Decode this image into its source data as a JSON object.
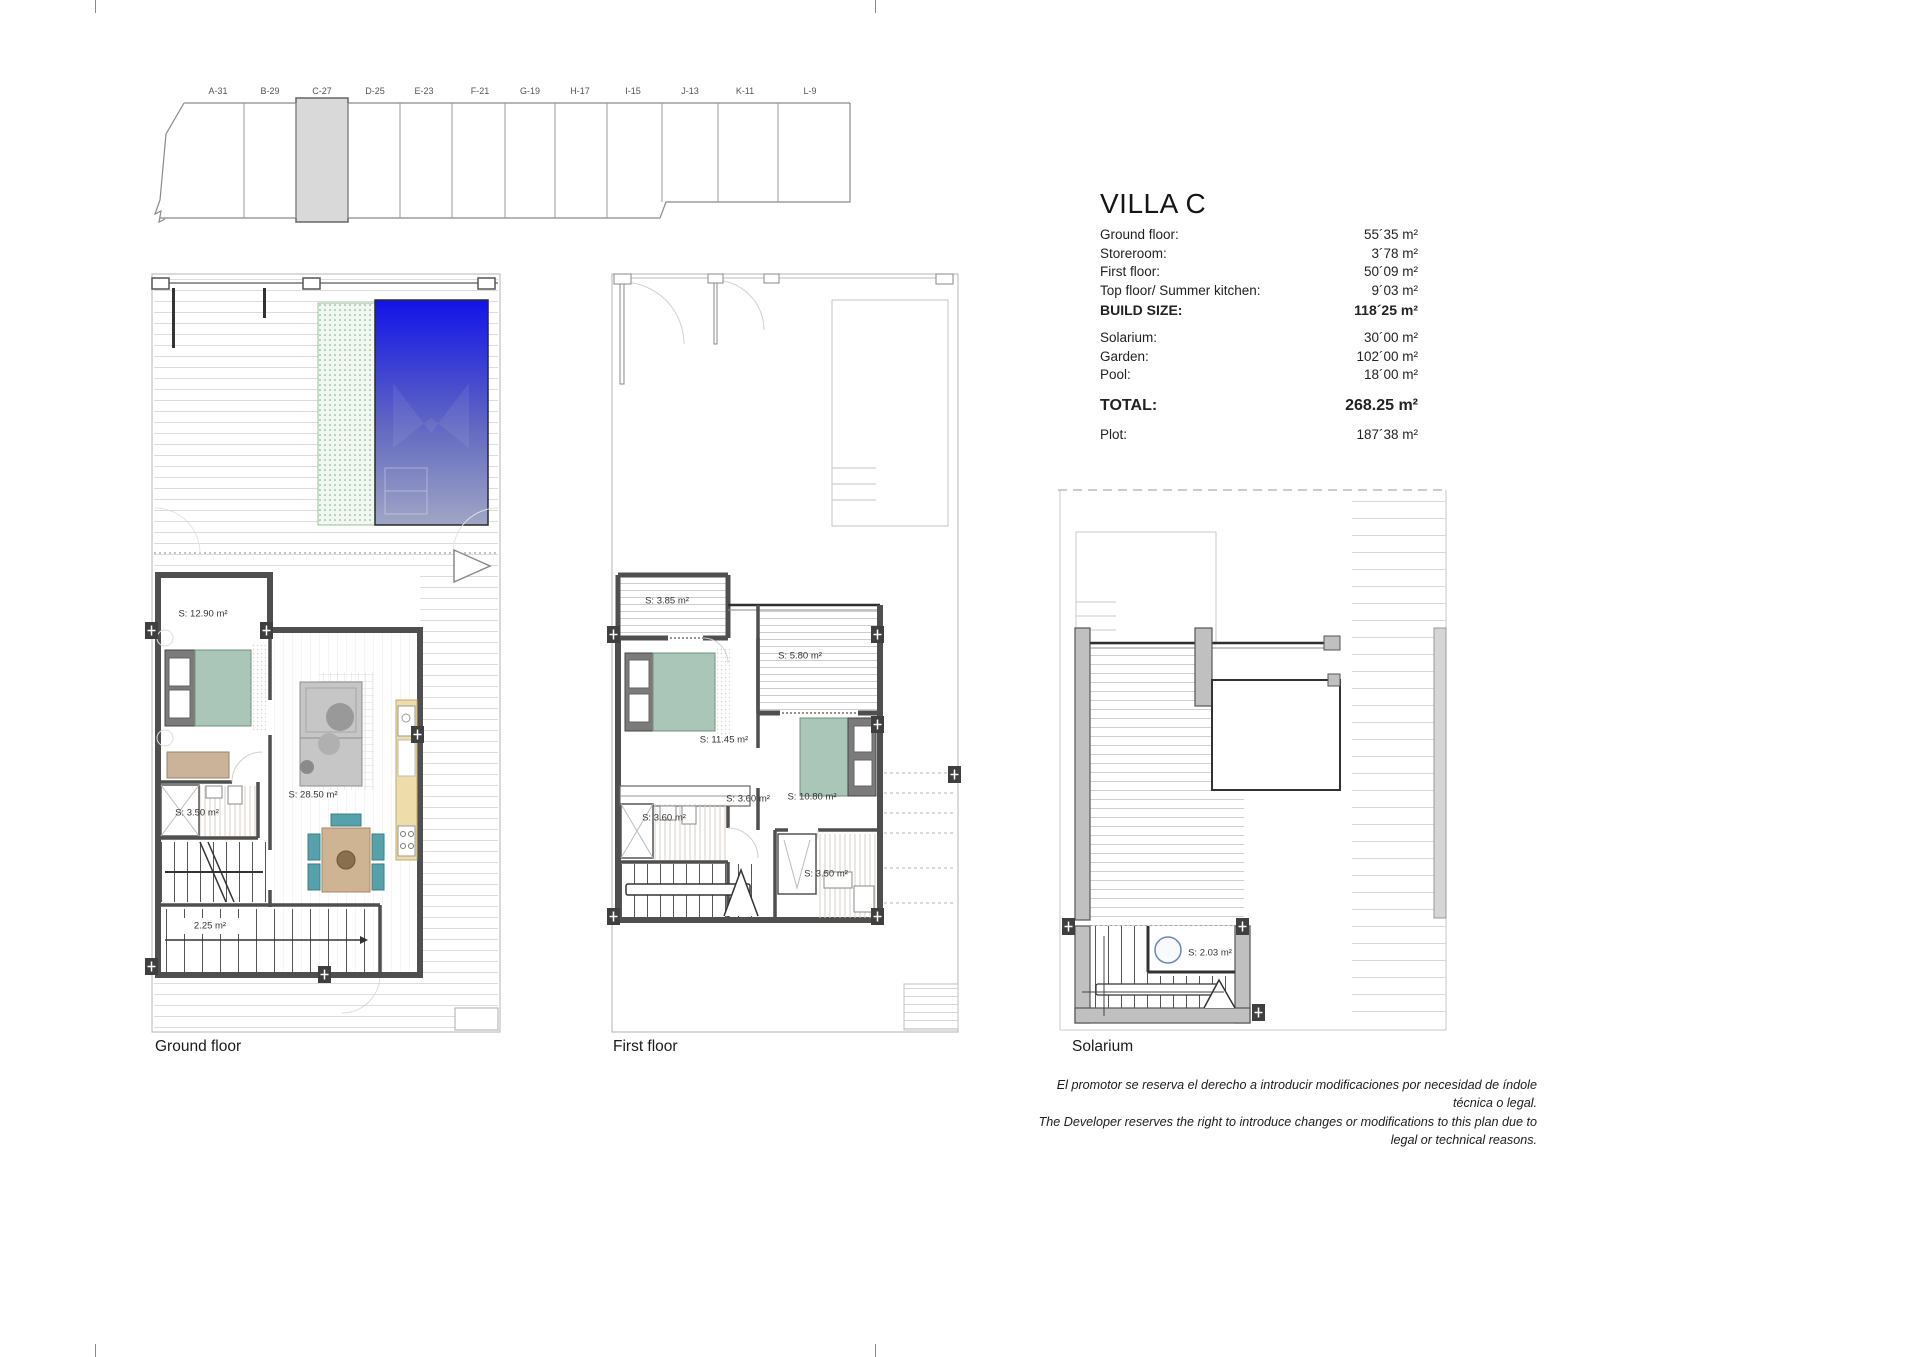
{
  "page": {
    "title": "VILLA C"
  },
  "siteplan": {
    "highlighted_unit": "C-27",
    "units": [
      {
        "label": "A-31"
      },
      {
        "label": "B-29"
      },
      {
        "label": "C-27"
      },
      {
        "label": "D-25"
      },
      {
        "label": "E-23"
      },
      {
        "label": "F-21"
      },
      {
        "label": "G-19"
      },
      {
        "label": "H-17"
      },
      {
        "label": "I-15"
      },
      {
        "label": "J-13"
      },
      {
        "label": "K-11"
      },
      {
        "label": "L-9"
      }
    ]
  },
  "areas": {
    "rows": [
      {
        "label": "Ground floor:",
        "value": "55´35 m²"
      },
      {
        "label": "Storeroom:",
        "value": "3´78 m²"
      },
      {
        "label": "First floor:",
        "value": "50´09 m²"
      },
      {
        "label": "Top floor/ Summer kitchen:",
        "value": "9´03 m²"
      },
      {
        "label": "BUILD SIZE:",
        "value": "118´25 m²"
      },
      {
        "label": "Solarium:",
        "value": "30´00 m²"
      },
      {
        "label": "Garden:",
        "value": "102´00 m²"
      },
      {
        "label": "Pool:",
        "value": "18´00 m²"
      },
      {
        "label": "TOTAL:",
        "value": "268.25 m²"
      },
      {
        "label": "Plot:",
        "value": "187´38 m²"
      }
    ]
  },
  "plans": {
    "ground": {
      "caption": "Ground floor",
      "rooms": {
        "bedroom": "S: 12.90 m²",
        "living": "S: 28.50 m²",
        "bath": "S: 3.50 m²",
        "store": "2.25 m²"
      }
    },
    "first": {
      "caption": "First floor",
      "rooms": {
        "balcony": "S: 3.85 m²",
        "terrace": "S: 5.80 m²",
        "bedroom1": "S: 11.45 m²",
        "hall": "S: 3.60 m²",
        "bath1": "S: 3.60 m²",
        "bedroom2": "S: 10.80 m²",
        "bath2": "S: 3.50 m²"
      }
    },
    "solarium": {
      "caption": "Solarium",
      "rooms": {
        "store": "S: 2.03 m²"
      }
    }
  },
  "disclaimer": {
    "es": "El promotor se reserva el derecho a introducir modificaciones por necesidad de índole técnica o legal.",
    "en": "The Developer reserves the right to introduce changes or modifications to this plan due to legal or technical reasons."
  },
  "colors": {
    "pool_top": "#1113e6",
    "pool_bottom": "#9aa0c8",
    "bed_teal": "#a9c6b8",
    "chair_teal": "#57a2aa",
    "wood_tan": "#cfb493",
    "kitchen_yellow": "#eeddaa",
    "wall_gray": "#4f4f4f",
    "unit_highlight": "#d9d9d9",
    "garden_dot_green": "#6fae6f"
  }
}
